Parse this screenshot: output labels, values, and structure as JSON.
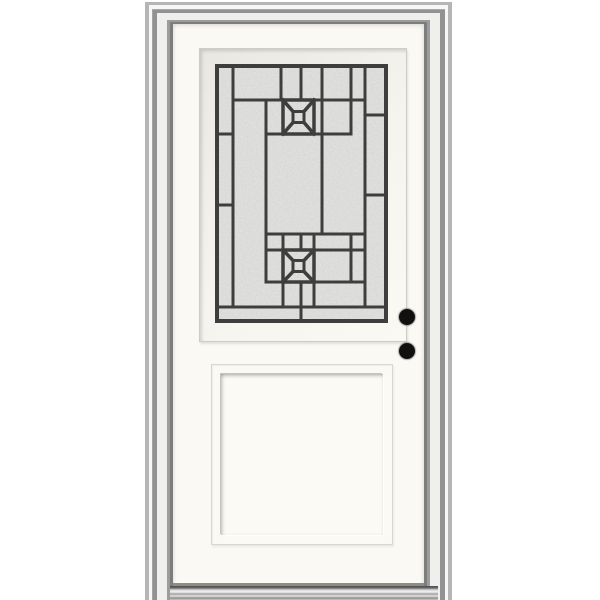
{
  "scene": {
    "type": "product-photo",
    "subject": "white prehung single entry door with decorative half-lite glass, recessed bottom panel, two bore holes and aluminum sill",
    "background_color": "#ffffff"
  },
  "colors": {
    "door_face": "#fbf9f3",
    "frame_gray": "#929292",
    "caming": "#3e3e3e",
    "glass_fill": "#d3d3d1",
    "bore_hole": "#101010",
    "sill_metal": "#c9c9c9"
  },
  "glass": {
    "x": 217,
    "y": 66,
    "width": 169,
    "height": 255,
    "border_stroke": 4,
    "line_stroke": 3,
    "verticals": [
      [
        233,
        66,
        307
      ],
      [
        266,
        100,
        282
      ],
      [
        281,
        66,
        100
      ],
      [
        301,
        66,
        100
      ],
      [
        322,
        66,
        234
      ],
      [
        351,
        66,
        100
      ],
      [
        365,
        66,
        307
      ],
      [
        351,
        100,
        134
      ],
      [
        283,
        234,
        250
      ],
      [
        301,
        234,
        250
      ],
      [
        314,
        234,
        250
      ],
      [
        351,
        234,
        282
      ],
      [
        283,
        282,
        307
      ],
      [
        301,
        282,
        307
      ],
      [
        314,
        282,
        307
      ],
      [
        301,
        307,
        321
      ]
    ],
    "horizontals": [
      [
        100,
        233,
        365
      ],
      [
        134,
        217,
        233
      ],
      [
        134,
        266,
        351
      ],
      [
        205,
        217,
        233
      ],
      [
        115,
        365,
        386
      ],
      [
        195,
        365,
        386
      ],
      [
        234,
        266,
        365
      ],
      [
        250,
        266,
        365
      ],
      [
        282,
        266,
        365
      ],
      [
        307,
        217,
        386
      ]
    ],
    "x_motifs": [
      {
        "x1": 283,
        "y1": 100,
        "x2": 314,
        "y2": 134,
        "center_half": 5.5
      },
      {
        "x1": 283,
        "y1": 250,
        "x2": 314,
        "y2": 282,
        "center_half": 5.5
      }
    ]
  },
  "hardware": {
    "bore_holes": [
      {
        "cx": 407,
        "cy": 317,
        "r": 8
      },
      {
        "cx": 407,
        "cy": 351,
        "r": 8
      }
    ]
  }
}
